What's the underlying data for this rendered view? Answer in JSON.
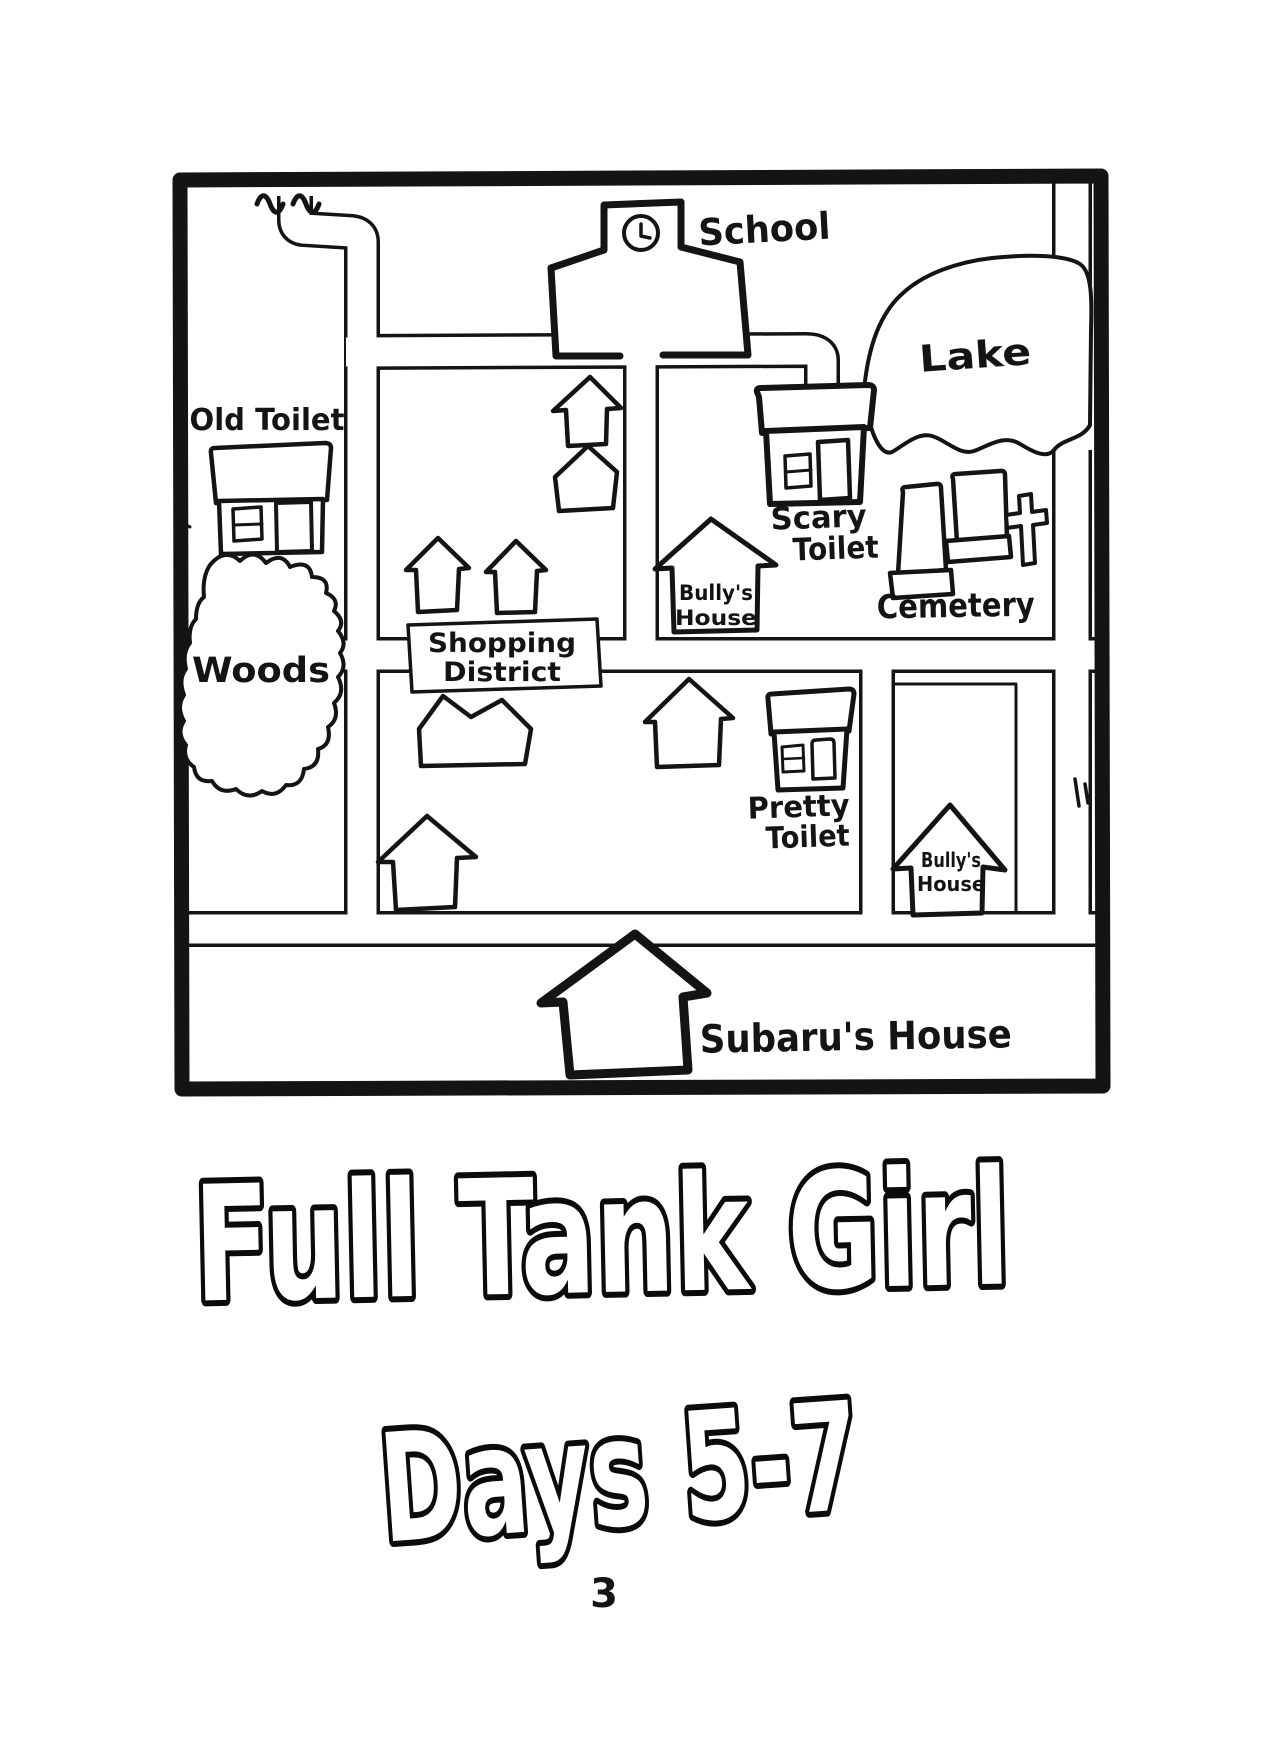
{
  "page": {
    "background": "#ffffff",
    "ink": "#141414"
  },
  "map": {
    "landmarks": {
      "school": "School",
      "lake": "Lake",
      "old_toilet": "Old Toilet",
      "woods": "Woods",
      "shopping_district": {
        "line1": "Shopping",
        "line2": "District"
      },
      "scary_toilet": {
        "line1": "Scary",
        "line2": "Toilet"
      },
      "bullys_house_north": {
        "line1": "Bully's",
        "line2": "House"
      },
      "cemetery": "Cemetery",
      "pretty_toilet": {
        "line1": "Pretty",
        "line2": "Toilet"
      },
      "bullys_house_east": {
        "line1": "Bully's",
        "line2": "House"
      },
      "subarus_house": "Subaru's House"
    }
  },
  "title": {
    "line1": "Full Tank Girl",
    "line2": "Days 5-7"
  },
  "page_number": "3"
}
